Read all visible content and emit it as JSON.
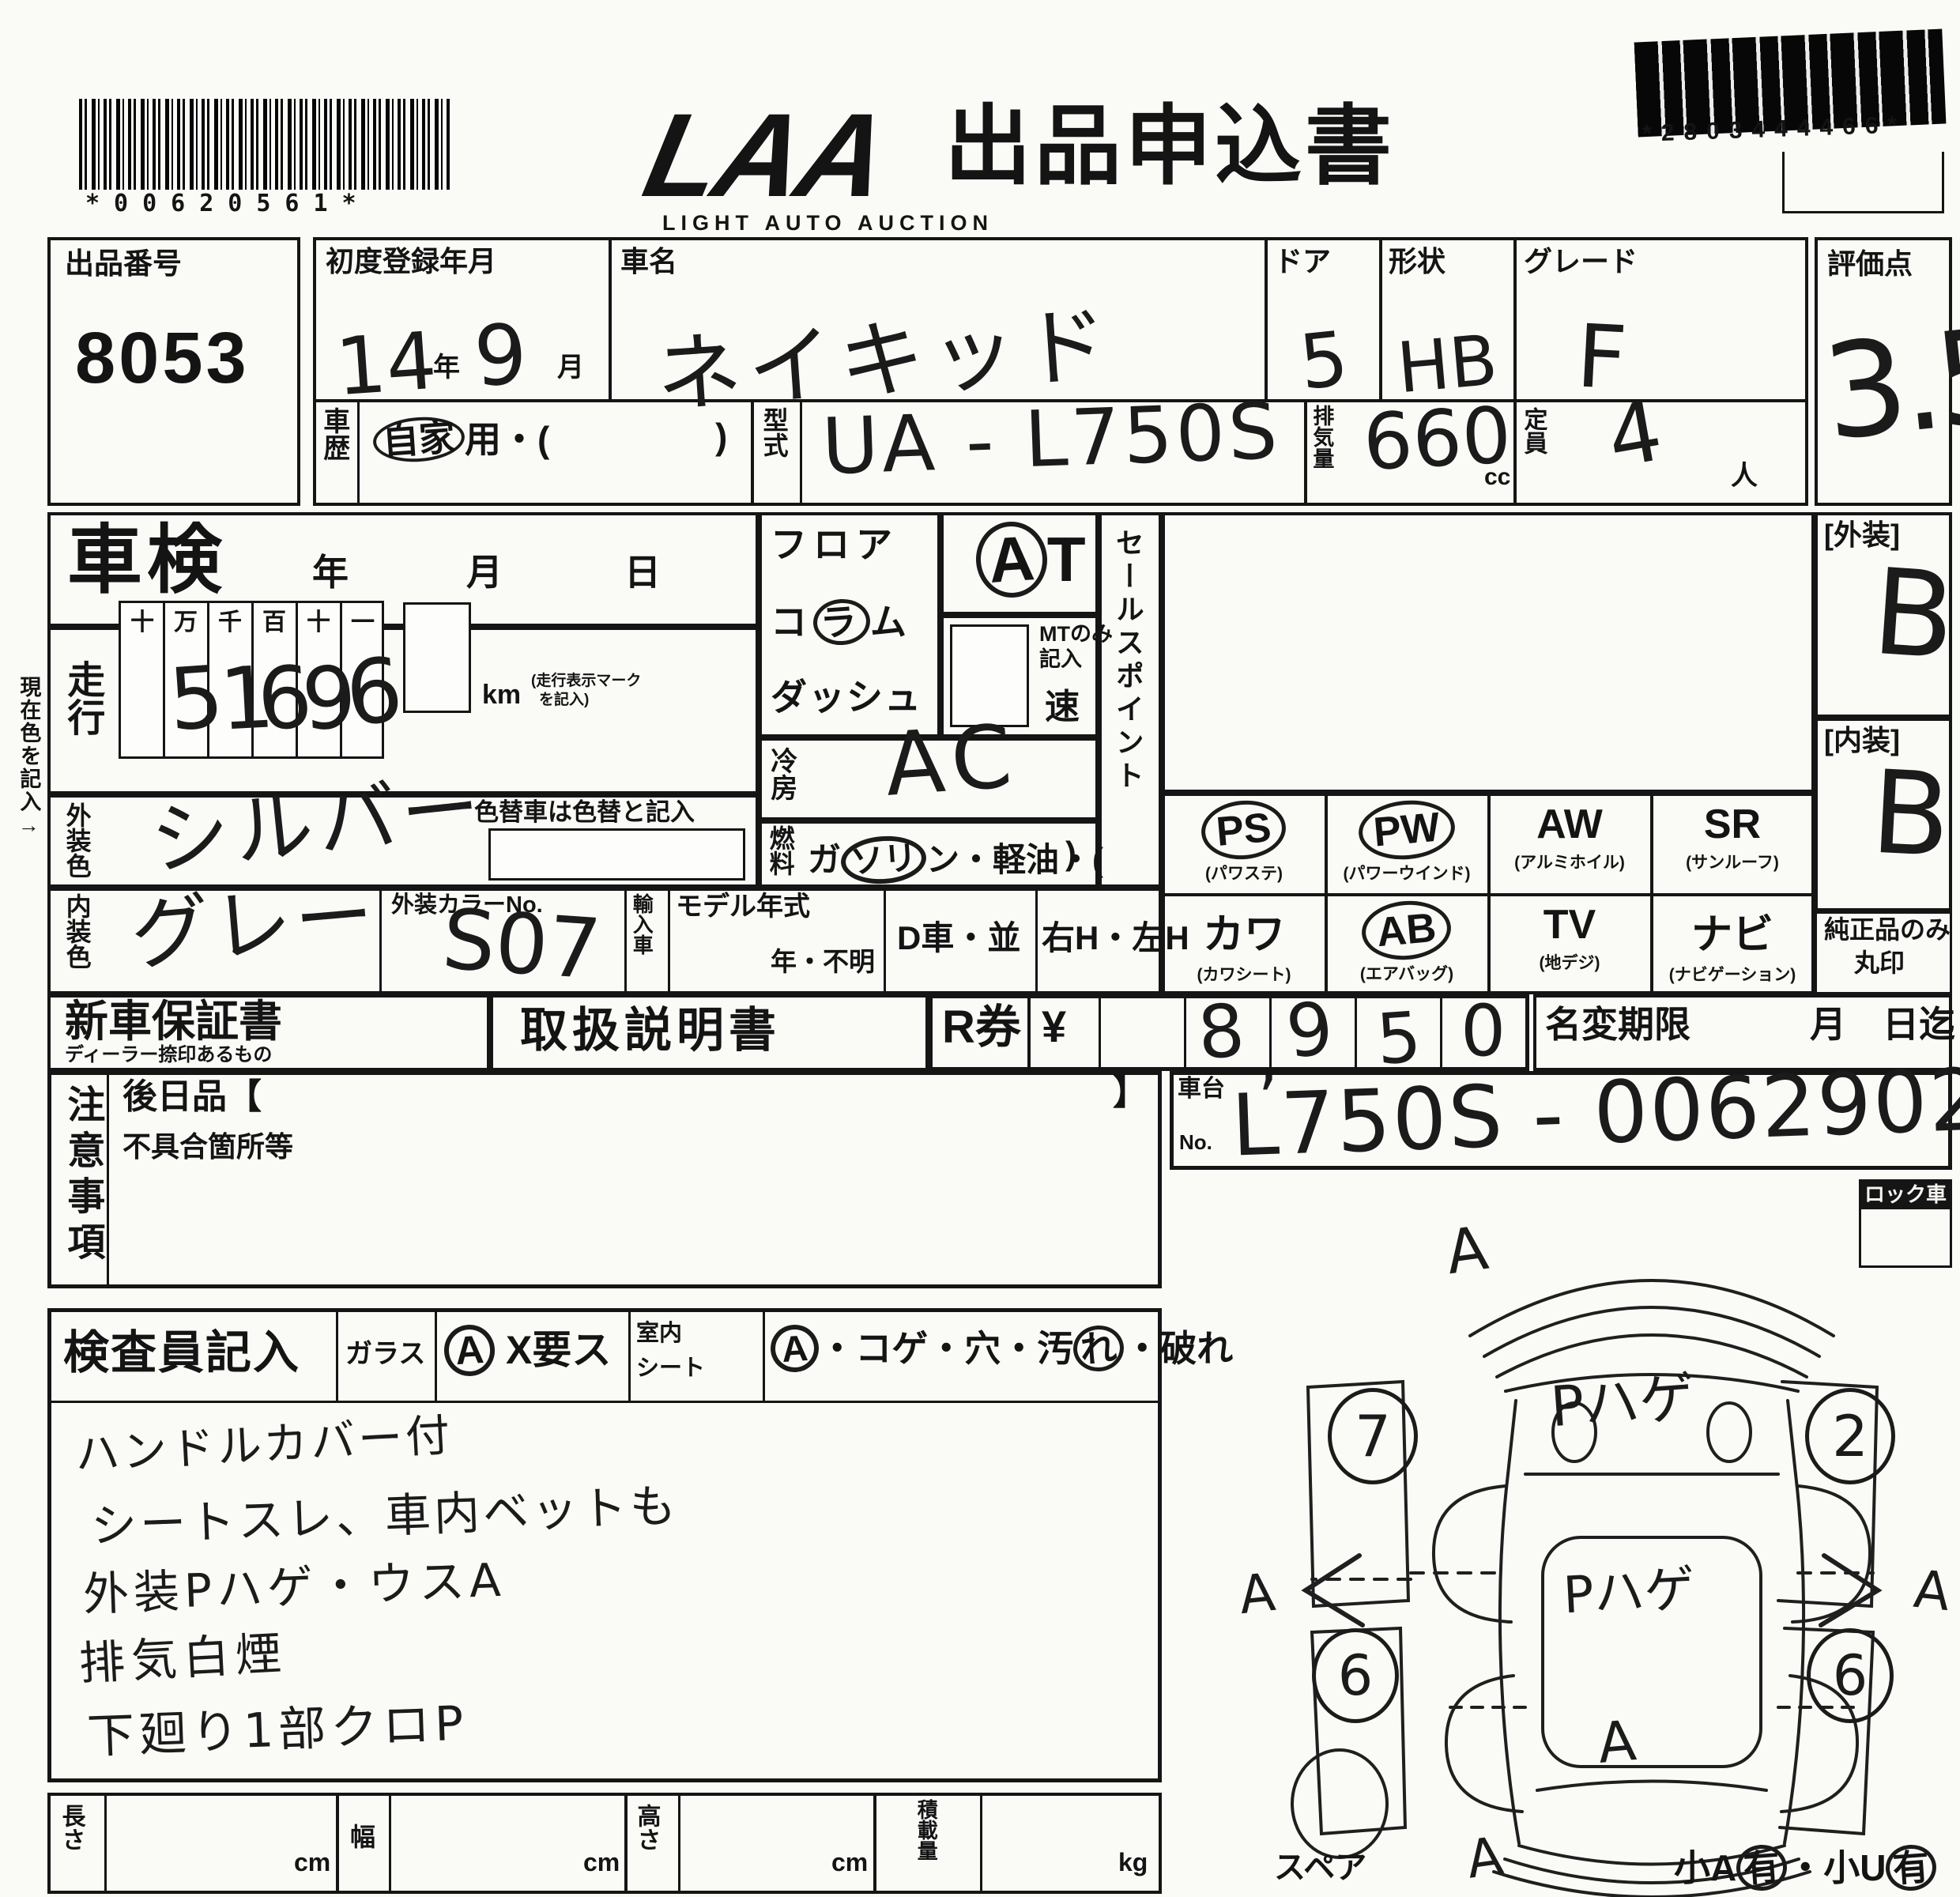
{
  "header": {
    "barcode_left_digits": "*00620561*",
    "logo_text": "LAA",
    "logo_sub": "LIGHT AUTO AUCTION",
    "form_title": "出品申込書",
    "barcode_right_digits": "*2803444466*"
  },
  "row1": {
    "entry_no_label": "出品番号",
    "entry_no": "8053",
    "first_reg_label": "初度登録年月",
    "reg_year": "14",
    "reg_year_unit": "年",
    "reg_month": "9",
    "reg_month_unit": "月",
    "history_label": "車歴",
    "history_circled": "自家",
    "history_rest": "用・(",
    "history_close": ")",
    "car_name_label": "車名",
    "car_name": "ネイキッド",
    "door_label": "ドア",
    "door_value": "5",
    "shape_label": "形状",
    "shape_value": "HB",
    "grade_label": "グレード",
    "grade_value": "F",
    "model_code_label": "型式",
    "model_code": "UA - L750S",
    "disp_label": "排気量",
    "disp_value": "660",
    "disp_unit": "cc",
    "capacity_label": "定員",
    "capacity_value": "4",
    "capacity_unit": "人",
    "score_label": "評価点",
    "score_value": "3.5"
  },
  "row2": {
    "current_color_note": "現在色を記入→",
    "shaken_label": "車検",
    "year_char": "年",
    "month_char": "月",
    "day_char": "日",
    "mileage_label": "走行",
    "odo_headers": [
      "十",
      "万",
      "千",
      "百",
      "十",
      "一"
    ],
    "odo_digits": [
      "",
      "5",
      "1",
      "6",
      "9",
      "6"
    ],
    "km_unit": "km",
    "km_note_1": "(走行表示マーク",
    "km_note_2": "を記入)",
    "ext_color_label": "外装色",
    "ext_color": "シルバー",
    "color_change_note": "色替車は色替と記入",
    "int_color_label": "内装色",
    "int_color": "グレー",
    "color_no_label": "外装カラーNo.",
    "color_no": "S07",
    "import_label": "輸入車",
    "model_year_label": "モデル年式",
    "model_year_value": "年・不明",
    "d_car_note": "D車・並",
    "handle_note": "右H・左H",
    "floor_label": "フロア",
    "column_pre": "コ",
    "column_circled": "ラ",
    "column_post": "ム",
    "dash_label": "ダッシュ",
    "at_circled": "A",
    "at_rest": "T",
    "mt_note_1": "MTのみ",
    "mt_note_2": "記入",
    "speed_char": "速",
    "cooling_label": "冷房",
    "cooling_value": "AC",
    "fuel_label": "燃料",
    "fuel_pre": "ガ",
    "fuel_circled": "ソリ",
    "fuel_post": "ン・軽油・(",
    "fuel_close": ")",
    "sales_point_label": "セールスポイント",
    "equipment": [
      {
        "code": "PS",
        "sub": "(パワステ)",
        "circled": true
      },
      {
        "code": "PW",
        "sub": "(パワーウインド)",
        "circled": true
      },
      {
        "code": "AW",
        "sub": "(アルミホイル)",
        "circled": false
      },
      {
        "code": "SR",
        "sub": "(サンルーフ)",
        "circled": false
      },
      {
        "code": "カワ",
        "sub": "(カワシート)",
        "circled": false
      },
      {
        "code": "AB",
        "sub": "(エアバッグ)",
        "circled": true
      },
      {
        "code": "TV",
        "sub": "(地デジ)",
        "circled": false
      },
      {
        "code": "ナビ",
        "sub": "(ナビゲーション)",
        "circled": false
      }
    ],
    "exterior_grade_label": "[外装]",
    "exterior_grade": "B",
    "interior_grade_label": "[内装]",
    "interior_grade": "B",
    "genuine_note_1": "純正品のみ",
    "genuine_note_2": "丸印"
  },
  "row3": {
    "warranty_label": "新車保証書",
    "warranty_sub": "ディーラー捺印あるもの",
    "manual_label": "取扱説明書",
    "rticket_label": "R券",
    "yen_sign": "¥",
    "amount_digits": [
      "8",
      "9",
      "5",
      "0"
    ],
    "amount_comma": ",",
    "name_change_label": "名変期限",
    "month_char": "月",
    "due_note": "日迄"
  },
  "row4": {
    "caution_label": "注意事項",
    "later_goods_label": "後日品【",
    "bracket_close": "】",
    "defect_label": "不具合箇所等",
    "chassis_label_1": "車台",
    "chassis_label_2": "No.",
    "chassis_no": "L750S - 0062902",
    "lock_label": "ロック車"
  },
  "inspector": {
    "label": "検査員記入",
    "glass_label": "ガラス",
    "glass_a": "A",
    "glass_note": "X要ス",
    "room_label_1": "室内",
    "room_label_2": "シート",
    "seat_a": "A",
    "seat_pre": "・コゲ・穴・汚",
    "seat_circled": "れ",
    "seat_post": "・破れ",
    "notes": [
      "ハンドルカバー付",
      "シートスレ、車内ベットも",
      "外装Pハゲ・ウスA",
      "排気白煙",
      "下廻り1部クロP"
    ]
  },
  "diagram": {
    "front_a": "A",
    "roof_mark": "Pハゲ",
    "center_mark": "Pハゲ",
    "left_a": "A",
    "right_a": "A",
    "trunk_a": "A",
    "rear_a": "A",
    "wheel_fl": "7",
    "wheel_fr": "2",
    "wheel_rl": "6",
    "wheel_rr": "6",
    "spare_label": "スペア",
    "corner_note_1": "小A",
    "corner_note_2": "有",
    "corner_note_3": "・小U",
    "corner_note_4": "有"
  },
  "bottom": {
    "length_label": "長さ",
    "width_label": "幅",
    "height_label": "高さ",
    "load_label": "積載量",
    "cm_1": "cm",
    "cm_2": "cm",
    "cm_3": "cm",
    "kg": "kg"
  }
}
